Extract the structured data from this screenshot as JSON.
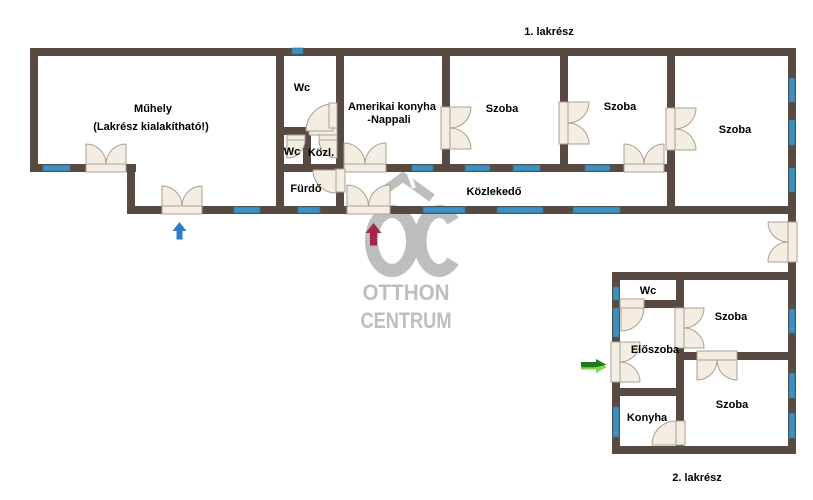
{
  "watermark": {
    "monogram": "OC",
    "line1": "OTTHON",
    "line2": "CENTRUM",
    "color": "#b7bab8"
  },
  "units": {
    "unit1_label": "1. lakrész",
    "unit2_label": "2. lakrész"
  },
  "unit1": {
    "muhely": "Műhely",
    "muhely_note": "(Lakrész kialakítható!)",
    "wc_top": "Wc",
    "wc_small": "Wc",
    "kozl": "Közl.",
    "furdo": "Fürdő",
    "amerikai_konyha_line1": "Amerikai konyha",
    "amerikai_konyha_line2": "-Nappali",
    "szoba1": "Szoba",
    "szoba2": "Szoba",
    "szoba3": "Szoba",
    "kozlekedo": "Közlekedő"
  },
  "unit2": {
    "wc": "Wc",
    "szoba_top": "Szoba",
    "eloszoba": "Előszoba",
    "konyha": "Konyha",
    "szoba_bottom": "Szoba"
  },
  "colors": {
    "wall": "#584a40",
    "window": "#3f90c1",
    "window_edge": "#2e7095",
    "door_fill": "#f4eee2",
    "door_stroke": "#a9a093",
    "watermark": "#b7bab8",
    "arrow_red": "#a12a4a",
    "arrow_blue": "#2d7bc9",
    "arrow_green_dark": "#1e7a1f",
    "arrow_green_light": "#8bd44f",
    "text": "#000000"
  }
}
